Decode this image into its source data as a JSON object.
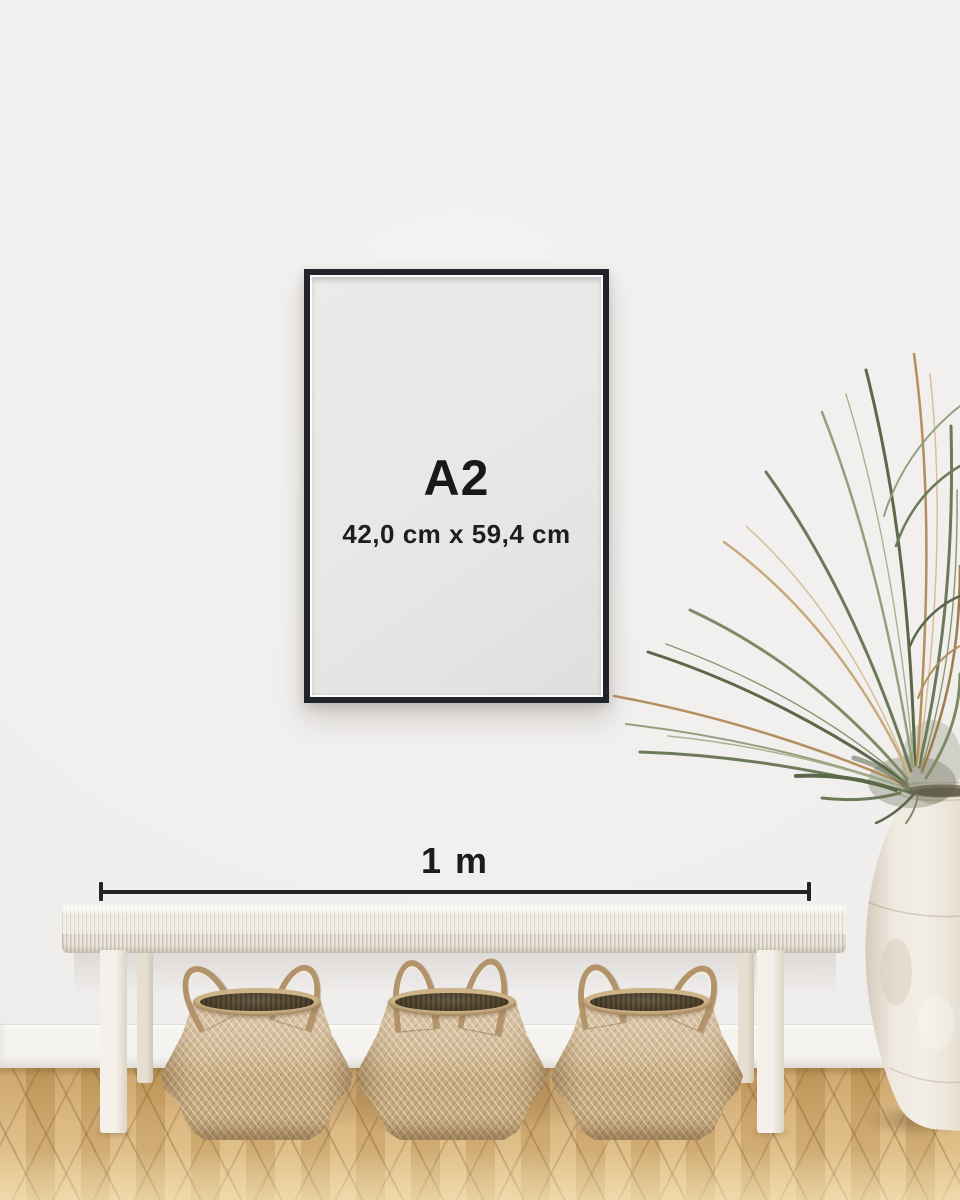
{
  "poster": {
    "size_label": "A2",
    "dimensions_label": "42,0 cm x 59,4 cm"
  },
  "measurement": {
    "label": "1 m"
  },
  "colors": {
    "wall": "#f1efee",
    "baseboard": "#f5f3ef",
    "frame": "#212428",
    "poster_bg": "#e9e7e5",
    "ink": "#17181b",
    "line": "#232428",
    "floor_a": "#c49a5c",
    "floor_b": "#d7b176",
    "floor_c": "#e3c489",
    "bench": "#f2eee6",
    "basket_a": "#c9ac82",
    "basket_b": "#b2936a",
    "vase_a": "#efe9e0",
    "plant_green": "#6d7a5a",
    "plant_tan": "#b3905e"
  }
}
